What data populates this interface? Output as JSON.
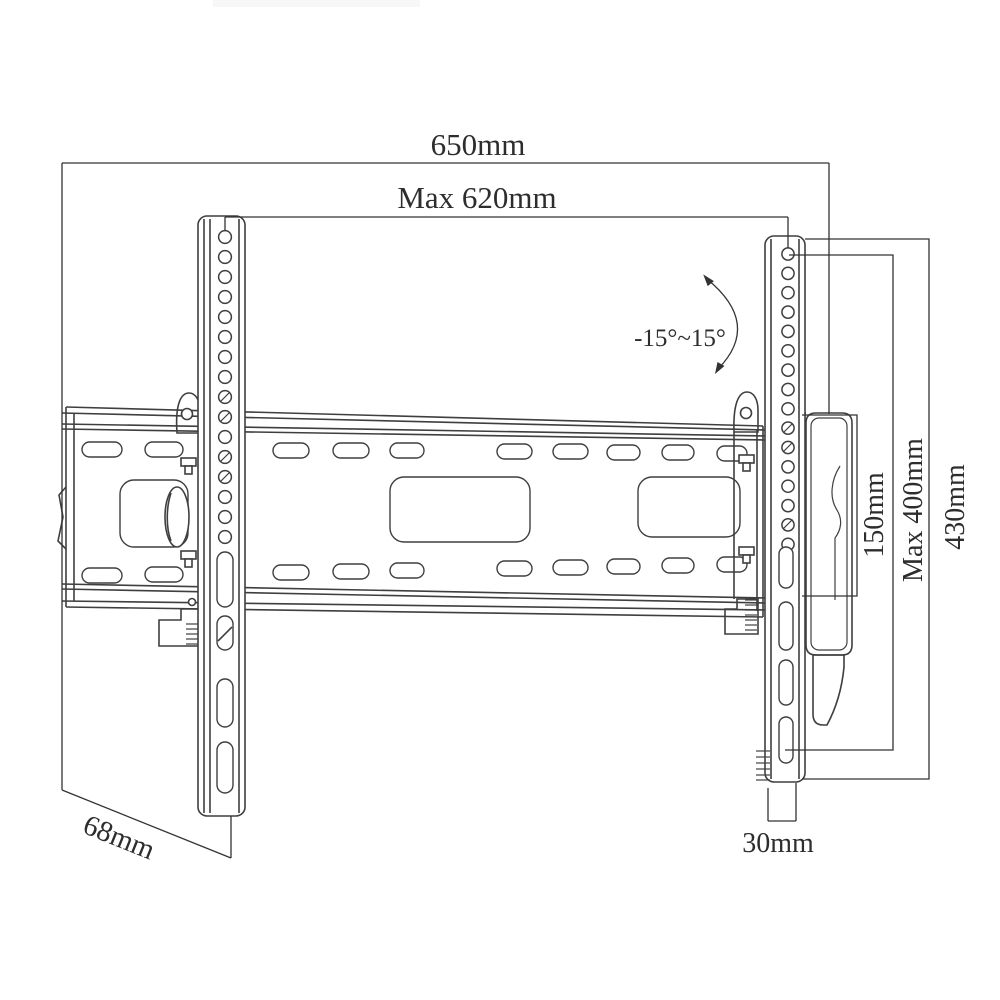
{
  "diagram": {
    "labels": {
      "overall_width": "650mm",
      "max_width": "Max 620mm",
      "tilt_range": "-15°~15°",
      "span_150": "150mm",
      "max_height": "Max 400mm",
      "total_height": "430mm",
      "depth_68": "68mm",
      "depth_30": "30mm"
    },
    "values_mm": {
      "overall_width": 650,
      "max_width": 620,
      "tilt_min_deg": -15,
      "tilt_max_deg": 15,
      "span": 150,
      "max_height": 400,
      "total_height": 430,
      "depth_rear": 68,
      "depth_bottom": 30
    },
    "colors": {
      "line": "#3f3f3f",
      "dimension": "#333333",
      "text": "#2d2d2d",
      "background": "#ffffff",
      "artifact": "#f7f7f7"
    }
  }
}
